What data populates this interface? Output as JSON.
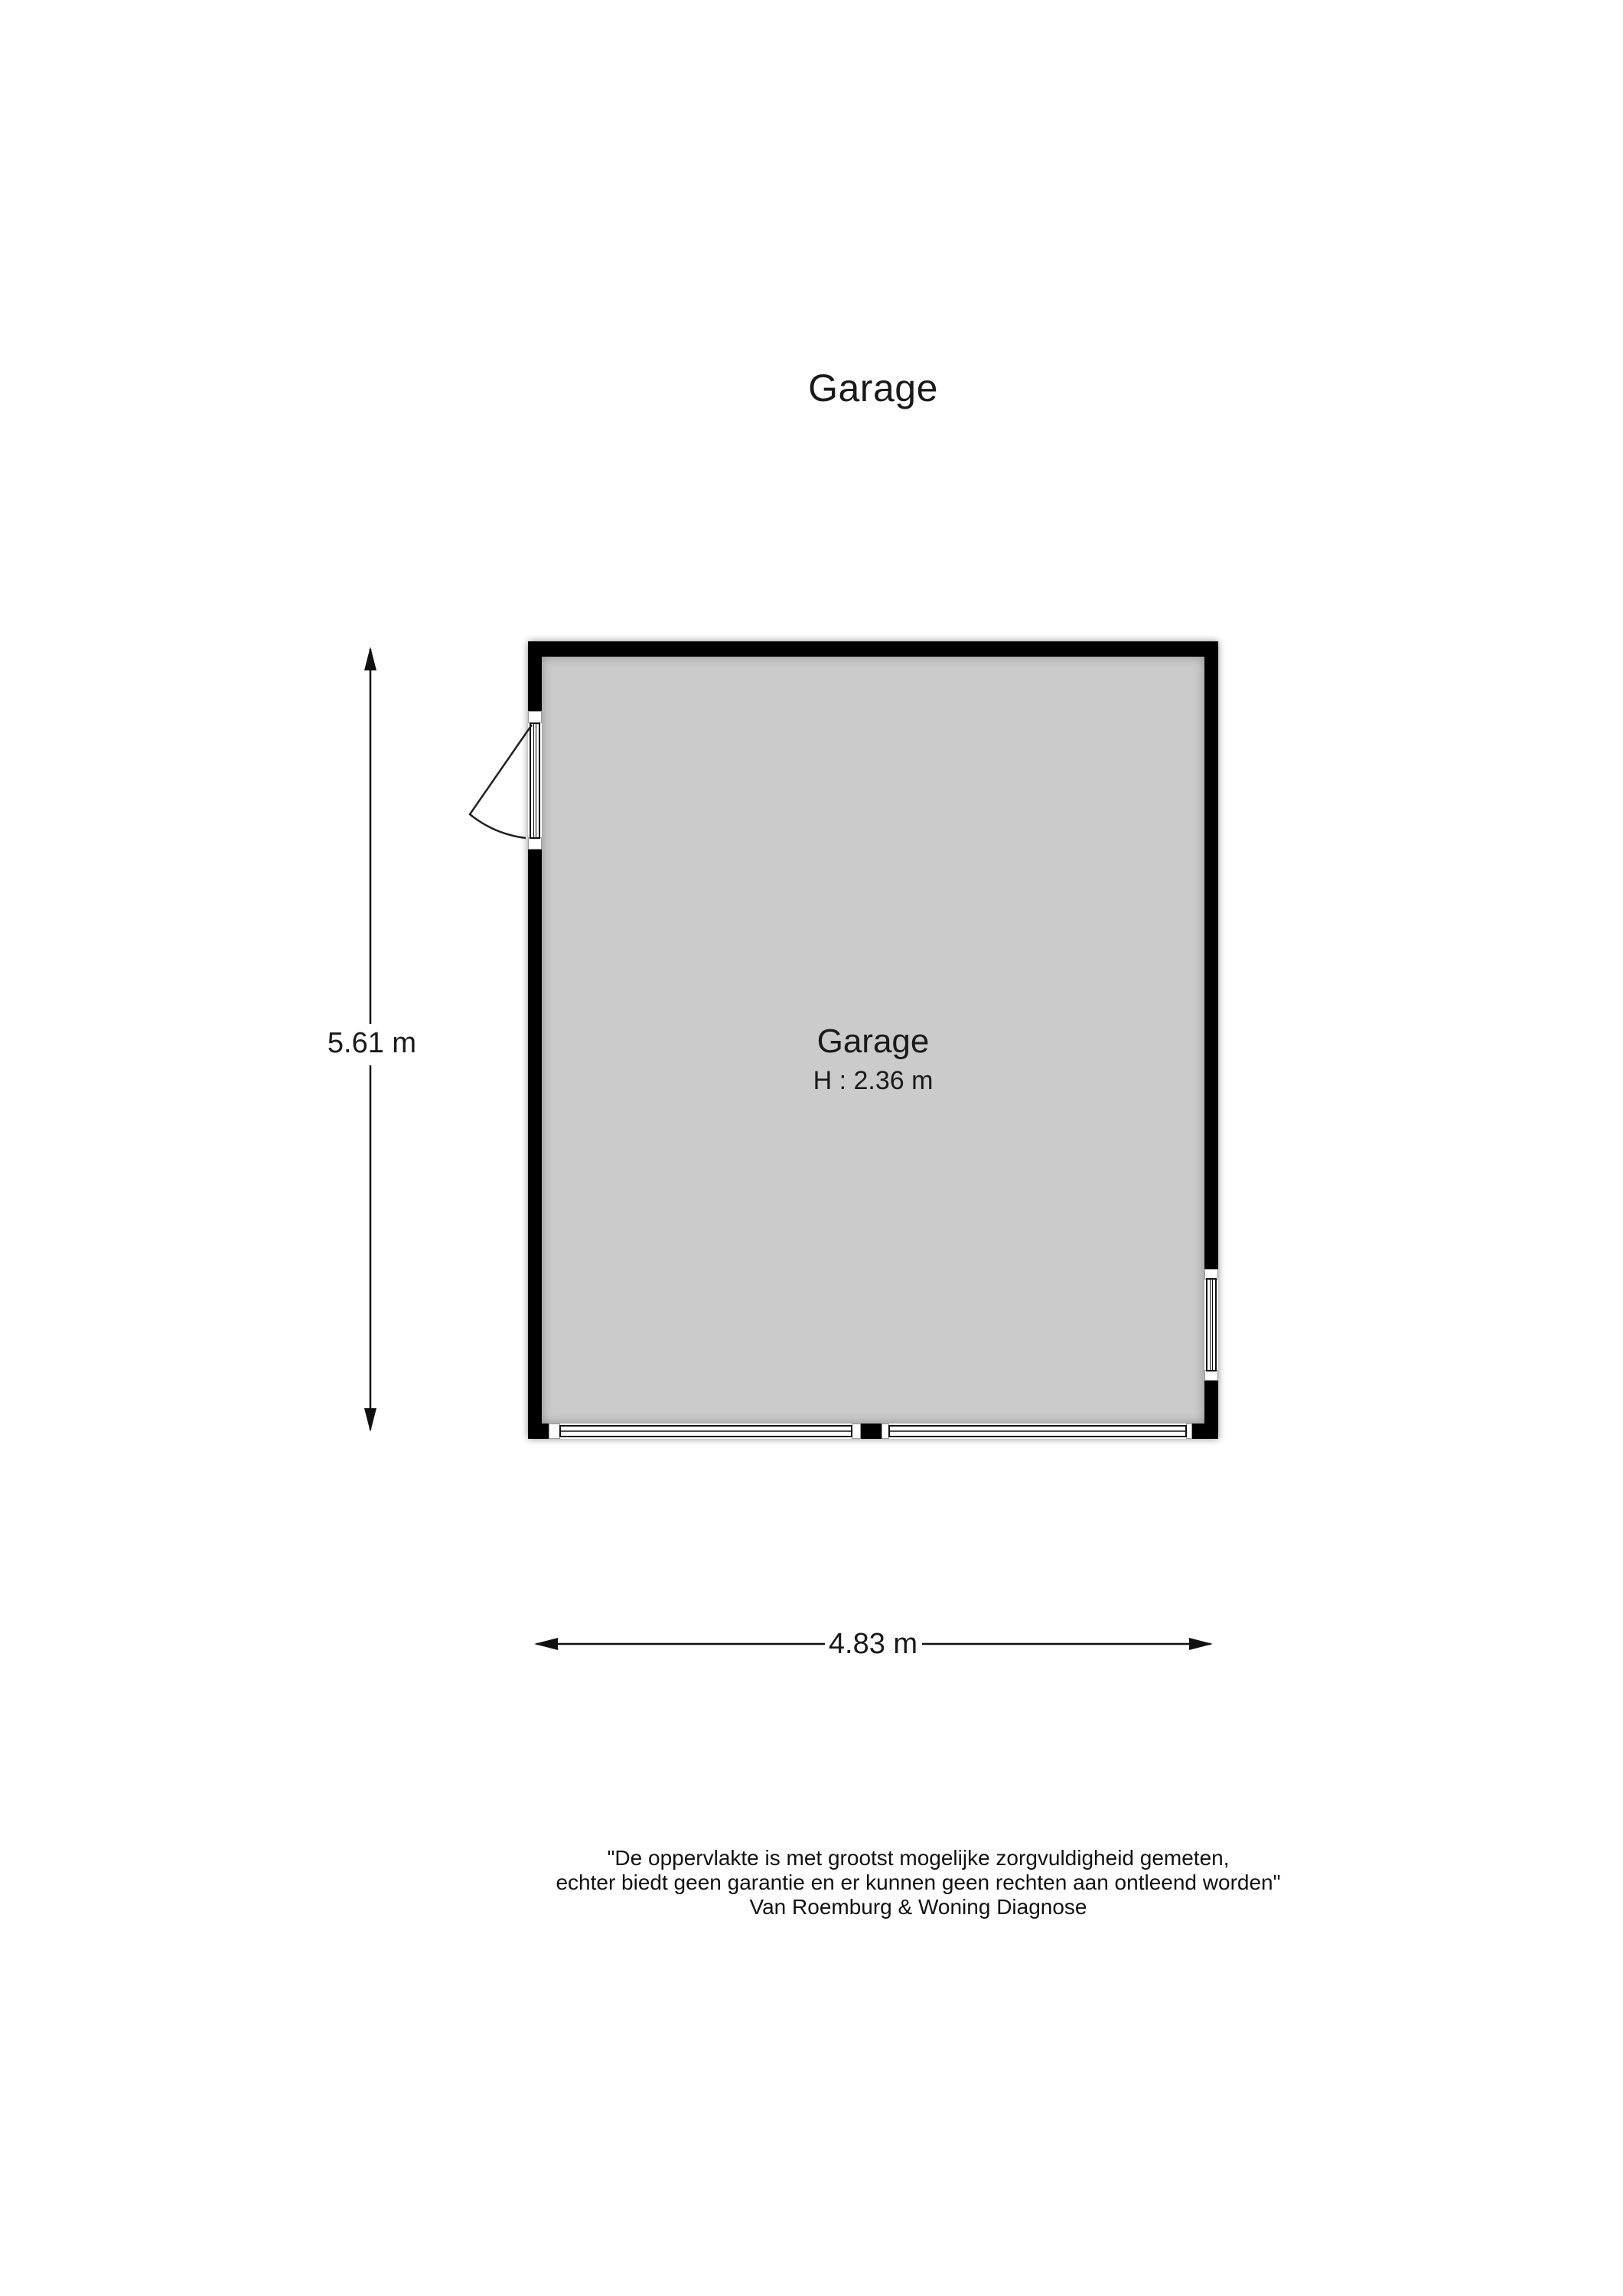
{
  "title": "Garage",
  "room": {
    "name": "Garage",
    "height_label": "H : 2.36 m"
  },
  "dimensions": {
    "height_label": "5.61 m",
    "width_label": "4.83 m"
  },
  "disclaimer": {
    "line1": "\"De oppervlakte is met grootst mogelijke zorgvuldigheid gemeten,",
    "line2": "echter biedt geen garantie en er kunnen geen rechten aan ontleend worden\"",
    "line3": "Van Roemburg & Woning Diagnose"
  },
  "colors": {
    "wall": "#000000",
    "floor": "#cbcbcb",
    "background": "#ffffff",
    "text": "#1a1a1a"
  }
}
